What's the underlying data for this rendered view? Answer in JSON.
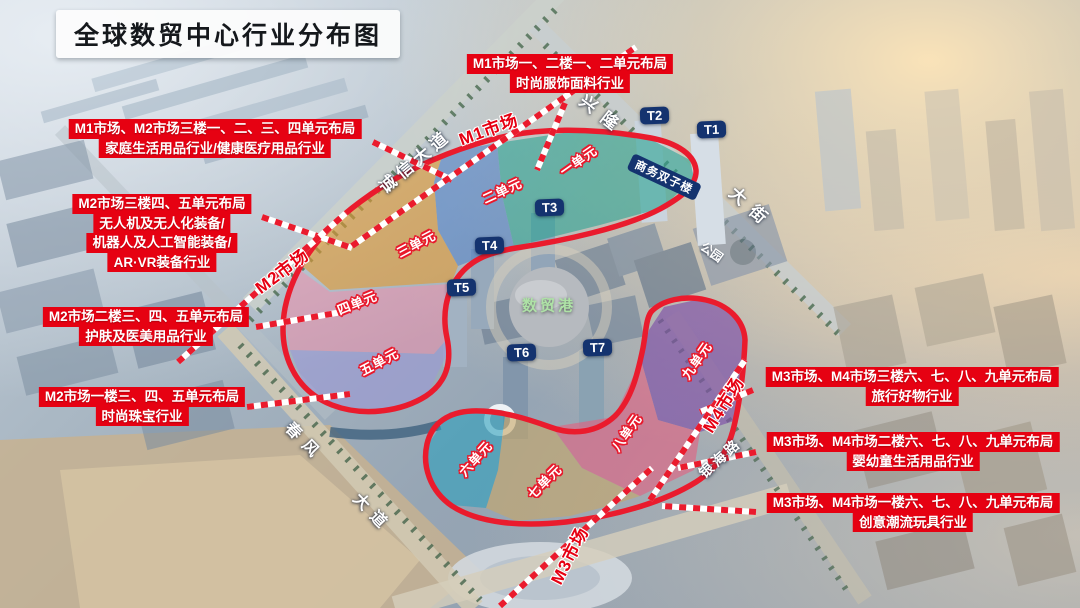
{
  "title": "全球数贸中心行业分布图",
  "annotations": [
    {
      "lines": [
        "M1市场一、二楼一、二单元布局",
        "时尚服饰面料行业"
      ]
    },
    {
      "lines": [
        "M1市场、M2市场三楼一、二、三、四单元布局",
        "家庭生活用品行业/健康医疗用品行业"
      ]
    },
    {
      "lines": [
        "M2市场三楼四、五单元布局",
        "无人机及无人化装备/",
        "机器人及人工智能装备/",
        "AR·VR装备行业"
      ]
    },
    {
      "lines": [
        "M2市场二楼三、四、五单元布局",
        "护肤及医美用品行业"
      ]
    },
    {
      "lines": [
        "M2市场一楼三、四、五单元布局",
        "时尚珠宝行业"
      ]
    },
    {
      "lines": [
        "M3市场、M4市场三楼六、七、八、九单元布局",
        "旅行好物行业"
      ]
    },
    {
      "lines": [
        "M3市场、M4市场二楼六、七、八、九单元布局",
        "婴幼童生活用品行业"
      ]
    },
    {
      "lines": [
        "M3市场、M4市场一楼六、七、八、九单元布局",
        "创意潮流玩具行业"
      ]
    }
  ],
  "markets": {
    "m1": "M1市场",
    "m2": "M2市场",
    "m3": "M3市场",
    "m4": "M4市场"
  },
  "units": {
    "u1": "一单元",
    "u2": "二单元",
    "u3": "三单元",
    "u4": "四单元",
    "u5": "五单元",
    "u6": "六单元",
    "u7": "七单元",
    "u8": "八单元",
    "u9": "九单元"
  },
  "buildings": {
    "t1": "T1",
    "t2": "T2",
    "t3": "T3",
    "t4": "T4",
    "t5": "T5",
    "t6": "T6",
    "t7": "T7",
    "twin_tower": "商务双子楼",
    "trade_port": "数贸港"
  },
  "roads": {
    "chengxin": "诚信大道",
    "xinglong": "兴隆",
    "dajie": "大街",
    "chunfeng": "春风",
    "dadao": "大道",
    "yinhai": "银海路"
  },
  "places": {
    "park": "公园"
  },
  "colors": {
    "annotation_bg": "#e60112",
    "outline": "#ea1b2d",
    "tag_bg": "#14336f",
    "port_text": "#aee2a6",
    "market_text": "#e60012",
    "u1": "#2ba393",
    "u2": "#4b7ec6",
    "u3": "#e29a2e",
    "u4": "#ef8fac",
    "u5": "#9b98d8",
    "u6": "#2fa0bd",
    "u7": "#c8a765",
    "u8": "#e45f7f",
    "u9": "#7e4fa8"
  }
}
